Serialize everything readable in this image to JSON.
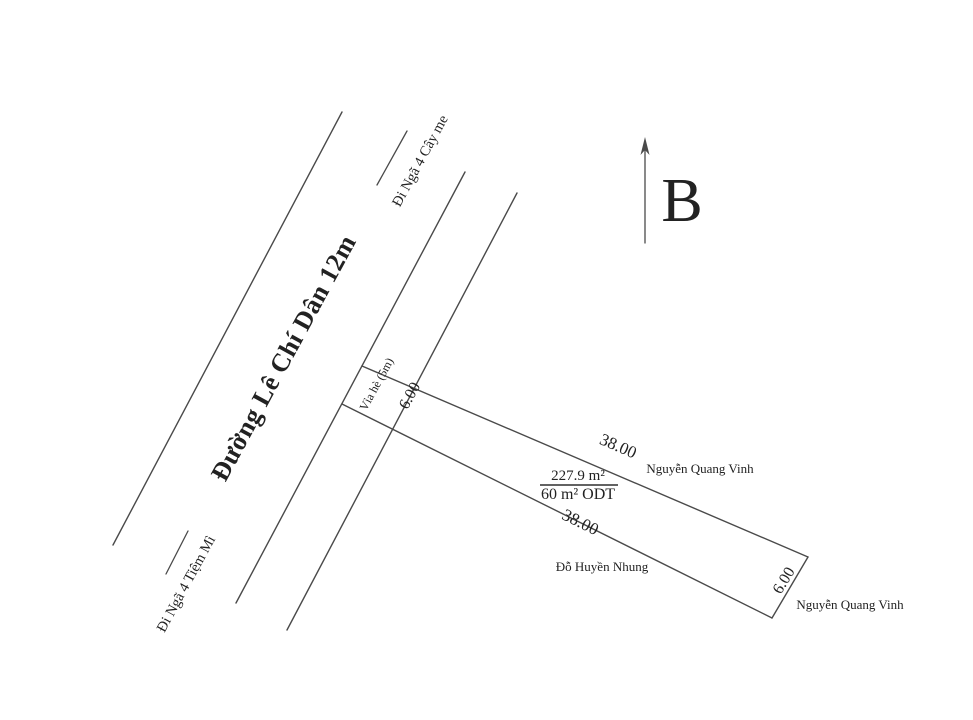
{
  "ink_color": "#222222",
  "line_color": "#4a4a4a",
  "north": {
    "label": "B"
  },
  "road": {
    "name": "Đường Lê Chí Dân 12m",
    "width_note_in_name": "12m",
    "direction_top": "Đi Ngã 4 Cây me",
    "direction_bottom": "Đi Ngã 4 Tiệm Mì"
  },
  "sidewalk": {
    "label": "Vỉa hè (5m)"
  },
  "parcel": {
    "area_total": "227.9 m²",
    "area_building": "60 m² ODT",
    "front_width": "6.00",
    "rear_width": "6.00",
    "length_top": "38.00",
    "length_bottom": "38.00"
  },
  "neighbors": {
    "north_owner": "Nguyễn Quang Vinh",
    "south_owner": "Đỗ Huyền Nhung",
    "east_owner": "Nguyễn Quang Vinh"
  }
}
